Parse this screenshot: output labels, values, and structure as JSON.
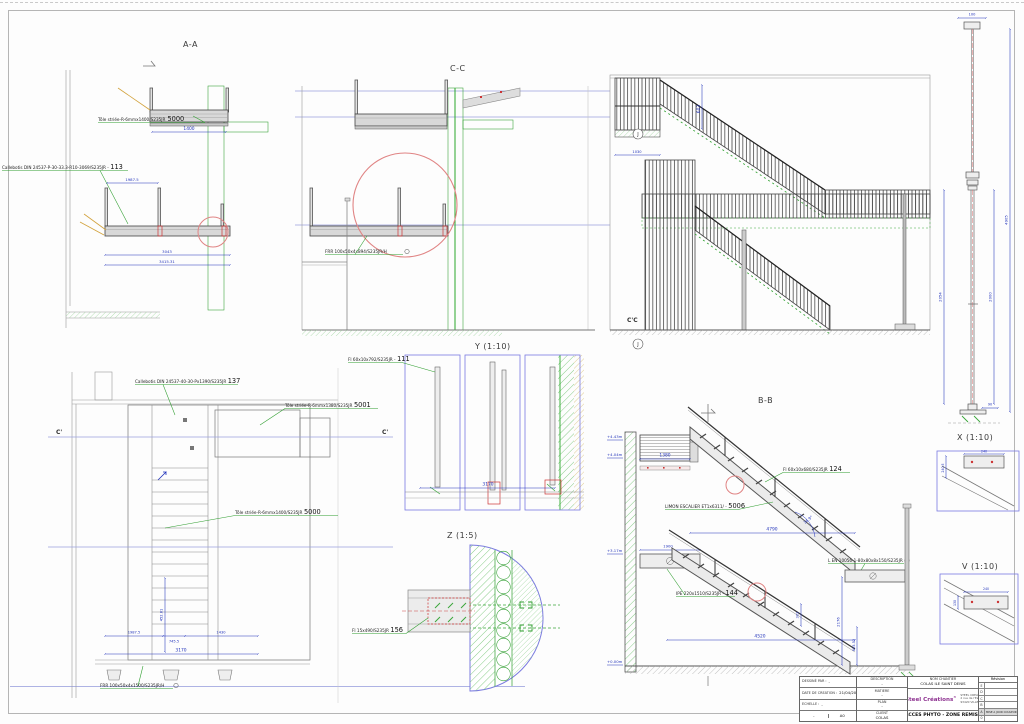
{
  "colors": {
    "dim_blue": "#2233bb",
    "level_blue": "#9aa0dd",
    "green": "#2f9e2f",
    "hatch_green": "#7cc87c",
    "detail_red": "#e08484",
    "connection_red": "#cc3333",
    "leader_orange": "#d2a23c",
    "brand_purple": "#8d3190",
    "steel_gray": "#555555"
  },
  "view_titles": {
    "aa": "A-A",
    "cc": "C-C",
    "y": "Y (1:10)",
    "z": "Z (1:5)",
    "bb": "B-B",
    "x": "X (1:10)",
    "v": "V (1:10)"
  },
  "aa": {
    "tole_label": "Tôle striée-R-6mmx1400/S235JR",
    "tole_mark": "5000",
    "cail_label": "Callebotis DIN 24537-P-30-33.3-R10-3069/S235JR -",
    "cail_mark": "113",
    "d1400": "1400",
    "d1987": "1987.5",
    "d3043": "3043",
    "d3415": "3415.31"
  },
  "cc": {
    "frr_label": "FRR 100x50x4x894/S235JR/H"
  },
  "ccelev": {
    "section": "C'C",
    "j": "J",
    "d603": "603",
    "d1030": "1030"
  },
  "y": {
    "fl_label": "Fl 60x10x792/S235JR -",
    "fl_mark": "111",
    "d3170": "3170"
  },
  "plan": {
    "cail_label": "Callebotis DIN 24537-40-30-Px1390/S235JR",
    "cail_mark": "137",
    "tole1_label": "Tôle striée-R-6mmx1380/S235JR",
    "tole1_mark": "5001",
    "tole2_label": "Tôle striée-R-6mmx1400/S235JR",
    "tole2_mark": "5000",
    "frr_label": "FRR 100x50x4x1500/S235JR/H",
    "c_left": "C'",
    "c_right": "C'",
    "d1987": "1987.5",
    "d745": "745.5",
    "d1430": "1430",
    "d3170": "3170",
    "d452": "452.81"
  },
  "z": {
    "fl_label": "Fl 15x490/S235JR",
    "fl_mark": "156"
  },
  "bb": {
    "fl_label": "Fl 60x10x680/S235JR",
    "fl_mark": "124",
    "limon_label": "LIMON ESCALIER ET1x6311/ -",
    "limon_mark": "5006",
    "l_label": "L EN 10056-1-80x80x8x150/S235JR",
    "ipe_label": "IPE 220x1510/S235JR -",
    "ipe_mark": "144",
    "d1380": "1380",
    "d4790": "4790",
    "d1900": "1900",
    "d4520": "4520",
    "d2176": "2176",
    "d625": "625.52",
    "d302": "302",
    "ang": "36.9°",
    "lv1": "+4.43m",
    "lv2": "+4.04m",
    "lv3": "+3.17m",
    "lv4": "+0.00m"
  },
  "x": {
    "d100": "100",
    "d2054": "2054",
    "d2000": "2000",
    "d4905": "4905",
    "d90": "90"
  },
  "xd": {
    "d240": "240",
    "d240b": "240.5"
  },
  "v": {
    "d240": "240",
    "d130": "130"
  },
  "tb": {
    "dessine_l": "DESSINÉ PAR :",
    "dessine_v": "-",
    "date_l": "DATE DE CREATION :",
    "date_v": "21/04/2023",
    "echelle_l": "ECHELLE :",
    "echelle_v": "-",
    "ind_v": "-",
    "format_v": "A0",
    "desc_l": "DESCRIPTION",
    "desc_v": "-",
    "mat_l": "MATIERE",
    "mat_v": "-",
    "plan_l": "PLAN",
    "plan_v": "-",
    "client_l": "CLIENT",
    "client_v": "COLAS",
    "chantier_l": "NOM CHANTIER",
    "chantier_v": "COLAS ILE SAINT DENIS",
    "logo": "Steel Créations",
    "logo_r": "®",
    "logo_initial": "S",
    "company": [
      "STEEL CREATIONS",
      "2 rue de l'Espérance",
      "93420 VILLEPINTE"
    ],
    "title": "ACCES PHYTO - ZONE REMISE",
    "rev_h": "Révision",
    "revs": [
      {
        "k": "E",
        "t": ""
      },
      {
        "k": "D",
        "t": ""
      },
      {
        "k": "C",
        "t": ""
      },
      {
        "k": "B",
        "t": ""
      },
      {
        "k": "A",
        "t": "MISE A JOUR COULEUR - INDICE"
      },
      {
        "k": "0",
        "t": ""
      }
    ]
  }
}
